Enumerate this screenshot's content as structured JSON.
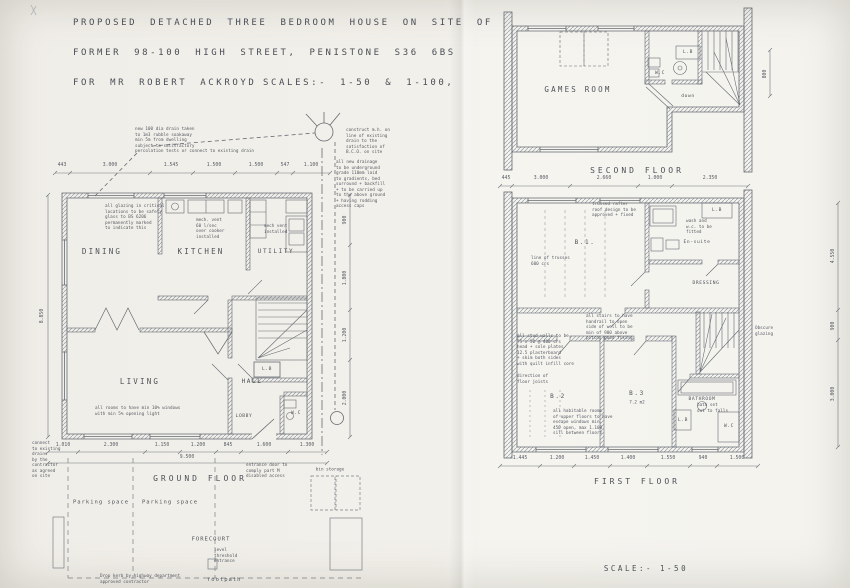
{
  "title_block": {
    "line1": "PROPOSED DETACHED THREE BEDROOM HOUSE ON SITE OF",
    "line2": "FORMER 98-100 HIGH STREET, PENISTONE S36 6BS",
    "line3": "FOR MR ROBERT ACKROYD",
    "scales": "SCALES:- 1-50 & 1-100,"
  },
  "ground_floor": {
    "title": "GROUND FLOOR",
    "rooms": {
      "dining": "DINING",
      "kitchen": "KITCHEN",
      "utility": "UTILITY",
      "living": "LIVING",
      "hall": "HALL",
      "lobby": "LOBBY",
      "wc": "W.C",
      "lb": "L.B"
    },
    "notes": {
      "soakaway": "new 100 dia drain taken\nto 1m3 rubble soakaway\nmin 5m from dwelling\nsubject to satisfactory\npercolation tests or connect to existing drain",
      "manhole": "construct m.h. on\nline of existing\ndrain to the\nsatisfaction of\nB.C.O. on site",
      "drainage": "all new drainage\nto be underground\ngrade 110mm laid\nto gradients, bed\nsurround + backfill\n+ to be carried up\nto the above ground\n+ having rodding\naccess caps",
      "glazing": "all glazing in critical\nlocations to be safety\nglass to BS 6206\npermanently marked\nto indicate this",
      "mech_vent": "mech. vent\n60 l/sec\nover cooker\ninstalled",
      "utility_vent": "mech vent\ninstalled",
      "living_windows": "all rooms to have min 10% windows\nwith min 5% opening light",
      "entrance": "entrance door to\ncomply part M\ndisabled access",
      "connect_drains": "connect\nto existing\ndrains\nby the\ncontractor\nas agreed\non site",
      "drop_kerb": "Drop kerb by highway department\napproved contractor",
      "threshold": "level\nthreshold\nentrance"
    },
    "site": {
      "parking1": "Parking space",
      "parking2": "Parking space",
      "forecourt": "FORECOURT",
      "bin_storage": "bin storage",
      "footpath": "footpath"
    },
    "dims_top": [
      "443",
      "3.000",
      "1.545",
      "1.500",
      "1.500",
      "547",
      "1.100"
    ],
    "dims_bottom": [
      "1.010",
      "2.300",
      "1.150",
      "1.200",
      "845",
      "1.600",
      "1.300"
    ],
    "dim_total": "9.500",
    "dim_left": "8.850",
    "dims_right": [
      "900",
      "1.800",
      "1.200",
      "2.000"
    ]
  },
  "second_floor": {
    "title": "SECOND FLOOR",
    "rooms": {
      "games": "GAMES ROOM",
      "wc": "W.C",
      "lb": "L.B"
    },
    "labels": {
      "down": "down"
    },
    "dims": [
      "445",
      "3.000",
      "2.660",
      "1.000",
      "2.350"
    ],
    "dim_right": "800"
  },
  "first_floor": {
    "title": "FIRST FLOOR",
    "rooms": {
      "b1": "B.1.",
      "b2": "B.2",
      "b3": "B.3",
      "b3_area": "7.2 m2",
      "ensuite": "En-suite",
      "dressing": "DRESSING",
      "bathroom": "BATHROOM",
      "lb1": "L.B",
      "lb2": "L.B",
      "wc": "W.C"
    },
    "notes": {
      "truss": "trussed rafter\nroof design to be\napproved + fixed",
      "trusses_line": "line of trusses\n600 crs",
      "wash": "wash and\nw.c. to be\nfitted",
      "handrail": "all stairs to have\nhandrail to open\nside of well to be\nmin of 900 above\npitch, good fixing",
      "stud_walls": "all stud walls to be\n75 x 50 @ 400 crs\nhead + sole plates\n12.5 plasterboard\n+ skim both sides\nwith quilt infill core",
      "joists": "direction of\nfloor joists",
      "escape": "all habitable rooms\nof upper floors to have\nescape windows min.\n450 open, max 1.100\nsill between floors",
      "bath": "bath set\nout to falls",
      "obscure": "Obscure\nglazing"
    },
    "dims_bottom": [
      "1.445",
      "1.200",
      "1.450",
      "1.400",
      "1.550",
      "940",
      "1.500"
    ],
    "dims_right": [
      "4.550",
      "900",
      "3.000"
    ]
  },
  "scale_note": "SCALE:- 1-50"
}
